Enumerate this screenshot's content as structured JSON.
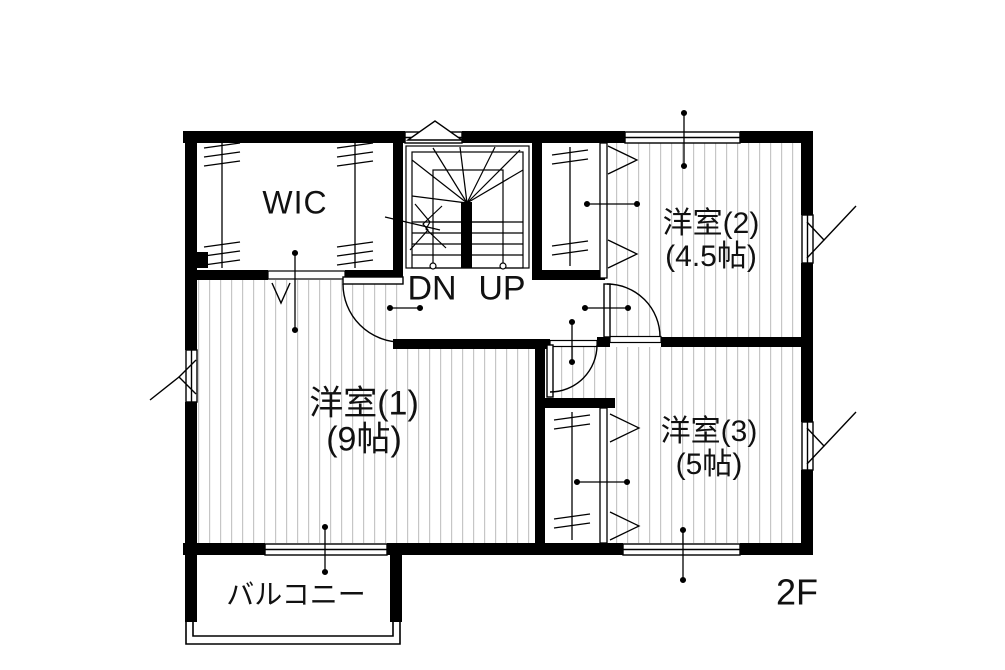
{
  "floor": {
    "label": "2F"
  },
  "rooms": {
    "wic": {
      "label": "WIC"
    },
    "room1": {
      "label": "洋室(1)",
      "size": "(9帖)"
    },
    "room2": {
      "label": "洋室(2)",
      "size": "(4.5帖)"
    },
    "room3": {
      "label": "洋室(3)",
      "size": "(5帖)"
    },
    "balcony": {
      "label": "バルコニー"
    }
  },
  "stairs": {
    "down_label": "DN",
    "up_label": "UP"
  },
  "colors": {
    "wall": "#000000",
    "hatch": "#c6c6c6",
    "background": "#ffffff",
    "text": "#111111"
  }
}
